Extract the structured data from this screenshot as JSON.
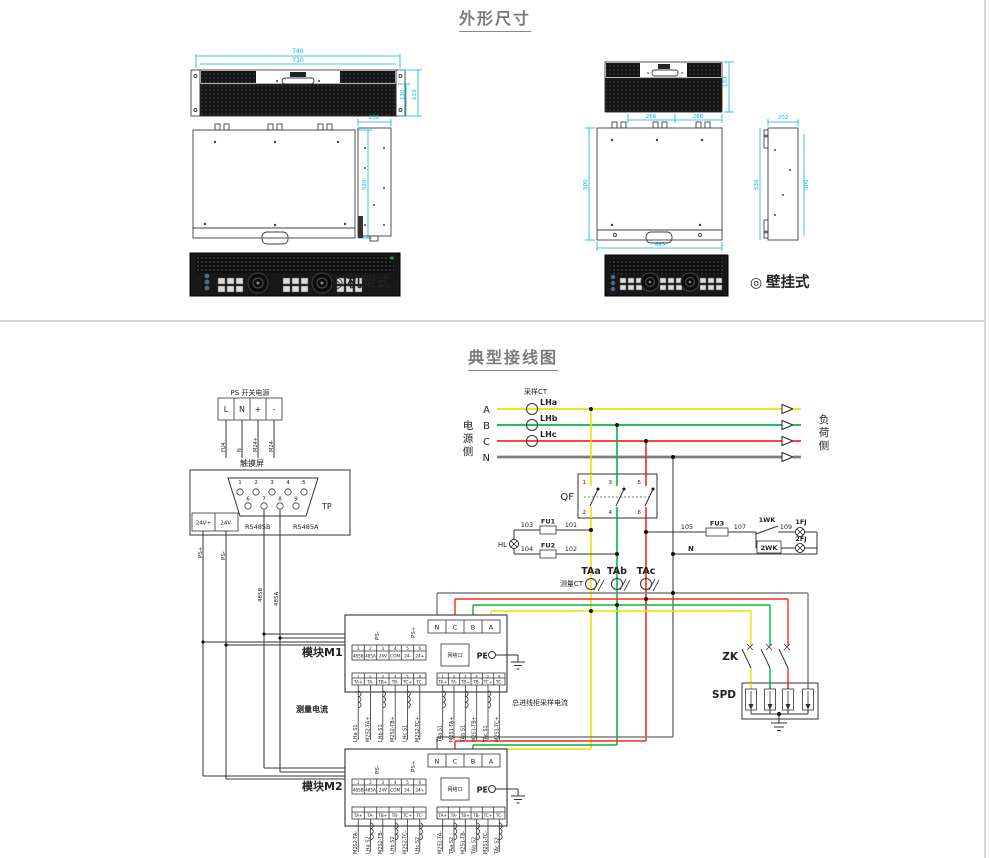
{
  "outline": {
    "title": "外形尺寸",
    "rack": {
      "bullet": "◎",
      "label": "机架式",
      "dim_w_outer": "740",
      "dim_w_inner": "710",
      "dim_h1": "130",
      "dim_h2": "133",
      "dim_depth": "520",
      "dim_side_top": "250"
    },
    "wall": {
      "bullet": "◎",
      "label": "壁挂式",
      "dim_front_h": "133",
      "dim_b1": "266",
      "dim_b2": "266",
      "dim_side_w": "202",
      "dim_top_h": "500",
      "dim_top_w": "665",
      "dim_side_h1": "530",
      "dim_side_h2": "500"
    }
  },
  "wiring": {
    "title": "典型接线图",
    "ps_supply": {
      "title": "PS 开关电源",
      "terminals": [
        "L",
        "N",
        "+",
        "-"
      ],
      "wire_labels": [
        "FU4",
        "N",
        "M24+",
        "M24-"
      ]
    },
    "touchscreen": {
      "title": "触摸屏",
      "tp": "TP",
      "pins_top": [
        "1",
        "2",
        "3",
        "4",
        "5"
      ],
      "pins_bottom": [
        "6",
        "7",
        "8",
        "9"
      ],
      "t24p": "24V+",
      "t24m": "24V-",
      "rs485b": "RS485B",
      "rs485a": "RS485A",
      "ps_plus": "PS+",
      "ps_minus": "PS-",
      "bus_b": "485B",
      "bus_a": "485A"
    },
    "mains": {
      "source_side": [
        "电",
        "源",
        "侧"
      ],
      "load_side": [
        "负",
        "荷",
        "侧"
      ],
      "phases": [
        "A",
        "B",
        "C",
        "N"
      ],
      "sampling_ct": "采样CT",
      "cts": [
        "LHa",
        "LHb",
        "LHc"
      ]
    },
    "qf": {
      "label": "QF",
      "contacts": [
        "1",
        "2",
        "3",
        "4",
        "5",
        "6"
      ]
    },
    "control": {
      "hl": "HL",
      "w103": "103",
      "fu1": "FU1",
      "w101": "101",
      "w104": "104",
      "fu2": "FU2",
      "w102": "102",
      "w105": "105",
      "fu3": "FU3",
      "w107": "107",
      "wk1": "1WK",
      "w109": "109",
      "fj1": "1FJ",
      "wk2": "2WK",
      "fj2": "2FJ",
      "n": "N"
    },
    "measure": {
      "label": "测量CT",
      "cts": [
        "TAa",
        "TAb",
        "TAc"
      ]
    },
    "zk": {
      "label": "ZK"
    },
    "spd": {
      "label": "SPD"
    },
    "m1": {
      "label": "模块M1",
      "terms": [
        "N",
        "C",
        "B",
        "A"
      ],
      "ps_minus": "PS-",
      "ps_plus": "PS+",
      "net_port": "网络口",
      "pe": "PE",
      "strip_nums": [
        "1",
        "2",
        "3",
        "4",
        "5",
        "6"
      ],
      "strip_labels": [
        "485B",
        "485A",
        "24V",
        "COM",
        "24-",
        "24+"
      ],
      "ct_labels": [
        "TA+",
        "TA-",
        "TB+",
        "TB-",
        "TC+",
        "TC-"
      ],
      "left_wires": [
        "LHa S1",
        "M2S2-TA+",
        "LHb S1",
        "M2S2-TB+",
        "LHc S1",
        "M2S2-TC+"
      ],
      "right_wires": [
        "TAa S1",
        "M2S1-TA+",
        "TAb S1",
        "M2S1-TB+",
        "TAc S1",
        "M2S1-TC+"
      ],
      "caption_left": "测量电流",
      "caption_right": "总进线柜采样电流"
    },
    "m2": {
      "label": "模块M2",
      "terms": [
        "N",
        "C",
        "B",
        "A"
      ],
      "ps_minus": "PS-",
      "ps_plus": "PS+",
      "net_port": "网络口",
      "pe": "PE",
      "strip_nums": [
        "1",
        "2",
        "3",
        "4",
        "5",
        "6"
      ],
      "strip_labels": [
        "485B",
        "485A",
        "24V",
        "COM",
        "24-",
        "24+"
      ],
      "ct_labels": [
        "TA+",
        "TA-",
        "TB+",
        "TB-",
        "TC+",
        "TC-"
      ],
      "left_wires": [
        "M2S2-TA-",
        "LHa S2",
        "M2S2-TB-",
        "LHb S2",
        "M2S2-TC-",
        "LHc S2"
      ],
      "right_wires": [
        "M2S1-TA-",
        "TAa S2",
        "M2S1-TB-",
        "TAb S2",
        "M2S1-TC-",
        "TAc S2"
      ]
    },
    "colors": {
      "phase_a": "#f0e000",
      "phase_b": "#00b840",
      "phase_c": "#fb2a1e",
      "phase_n": "#7e7e7e",
      "dim": "#00b0e8",
      "accent": "#e06666"
    }
  }
}
